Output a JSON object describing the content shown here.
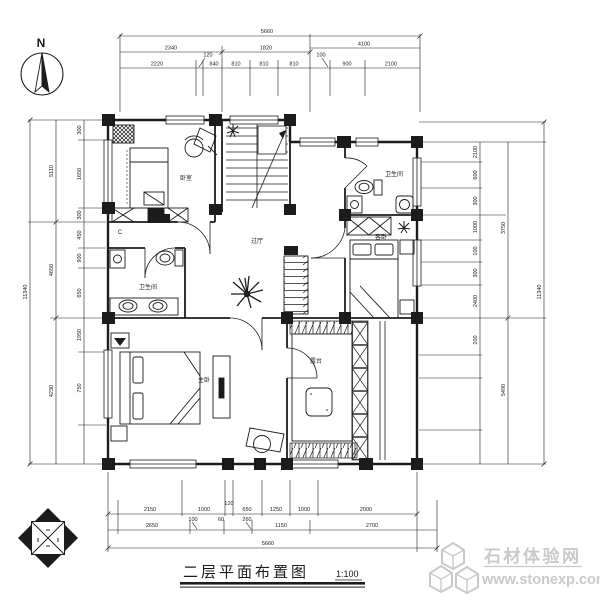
{
  "compass": {
    "label": "N"
  },
  "dims": {
    "top": {
      "overall": "5660",
      "mid": [
        "2340",
        "1820",
        "4100"
      ],
      "inner": [
        "2220",
        "120",
        "840",
        "810",
        "810",
        "810",
        "100",
        "900",
        "2100"
      ]
    },
    "left": {
      "overall": "11340",
      "mid": [
        "5110",
        "4650",
        "4230"
      ],
      "inner": [
        "300",
        "1650",
        "300",
        "450",
        "900",
        "650",
        "1950",
        "750"
      ]
    },
    "right": {
      "overall": "11340",
      "mid": [
        "3750",
        "5490"
      ],
      "inner": [
        "2100",
        "600",
        "300",
        "1000",
        "100",
        "300",
        "2400",
        "200"
      ]
    },
    "bottom": {
      "overall": "5660",
      "mid": [
        "2650",
        "100",
        "60",
        "260",
        "1150",
        "2700"
      ],
      "inner": [
        "2150",
        "1000",
        "120",
        "650",
        "1250",
        "1000",
        "2000"
      ]
    }
  },
  "rooms": {
    "bedroom_tl": "卧室",
    "hall": "过厅",
    "bath_left": "卫生间",
    "bath_right": "卫生间",
    "bedroom_right": "客卧",
    "master": "主卧",
    "terrace": "露台",
    "closet": "C"
  },
  "title": {
    "text": "二层平面布置图",
    "scale": "1:100"
  },
  "watermark": {
    "line1": "石材体验网",
    "line2": "www.stonexp.com"
  },
  "colors": {
    "ink": "#1c1c1c",
    "watermark": "#c9c9c9",
    "paper": "#ffffff"
  }
}
